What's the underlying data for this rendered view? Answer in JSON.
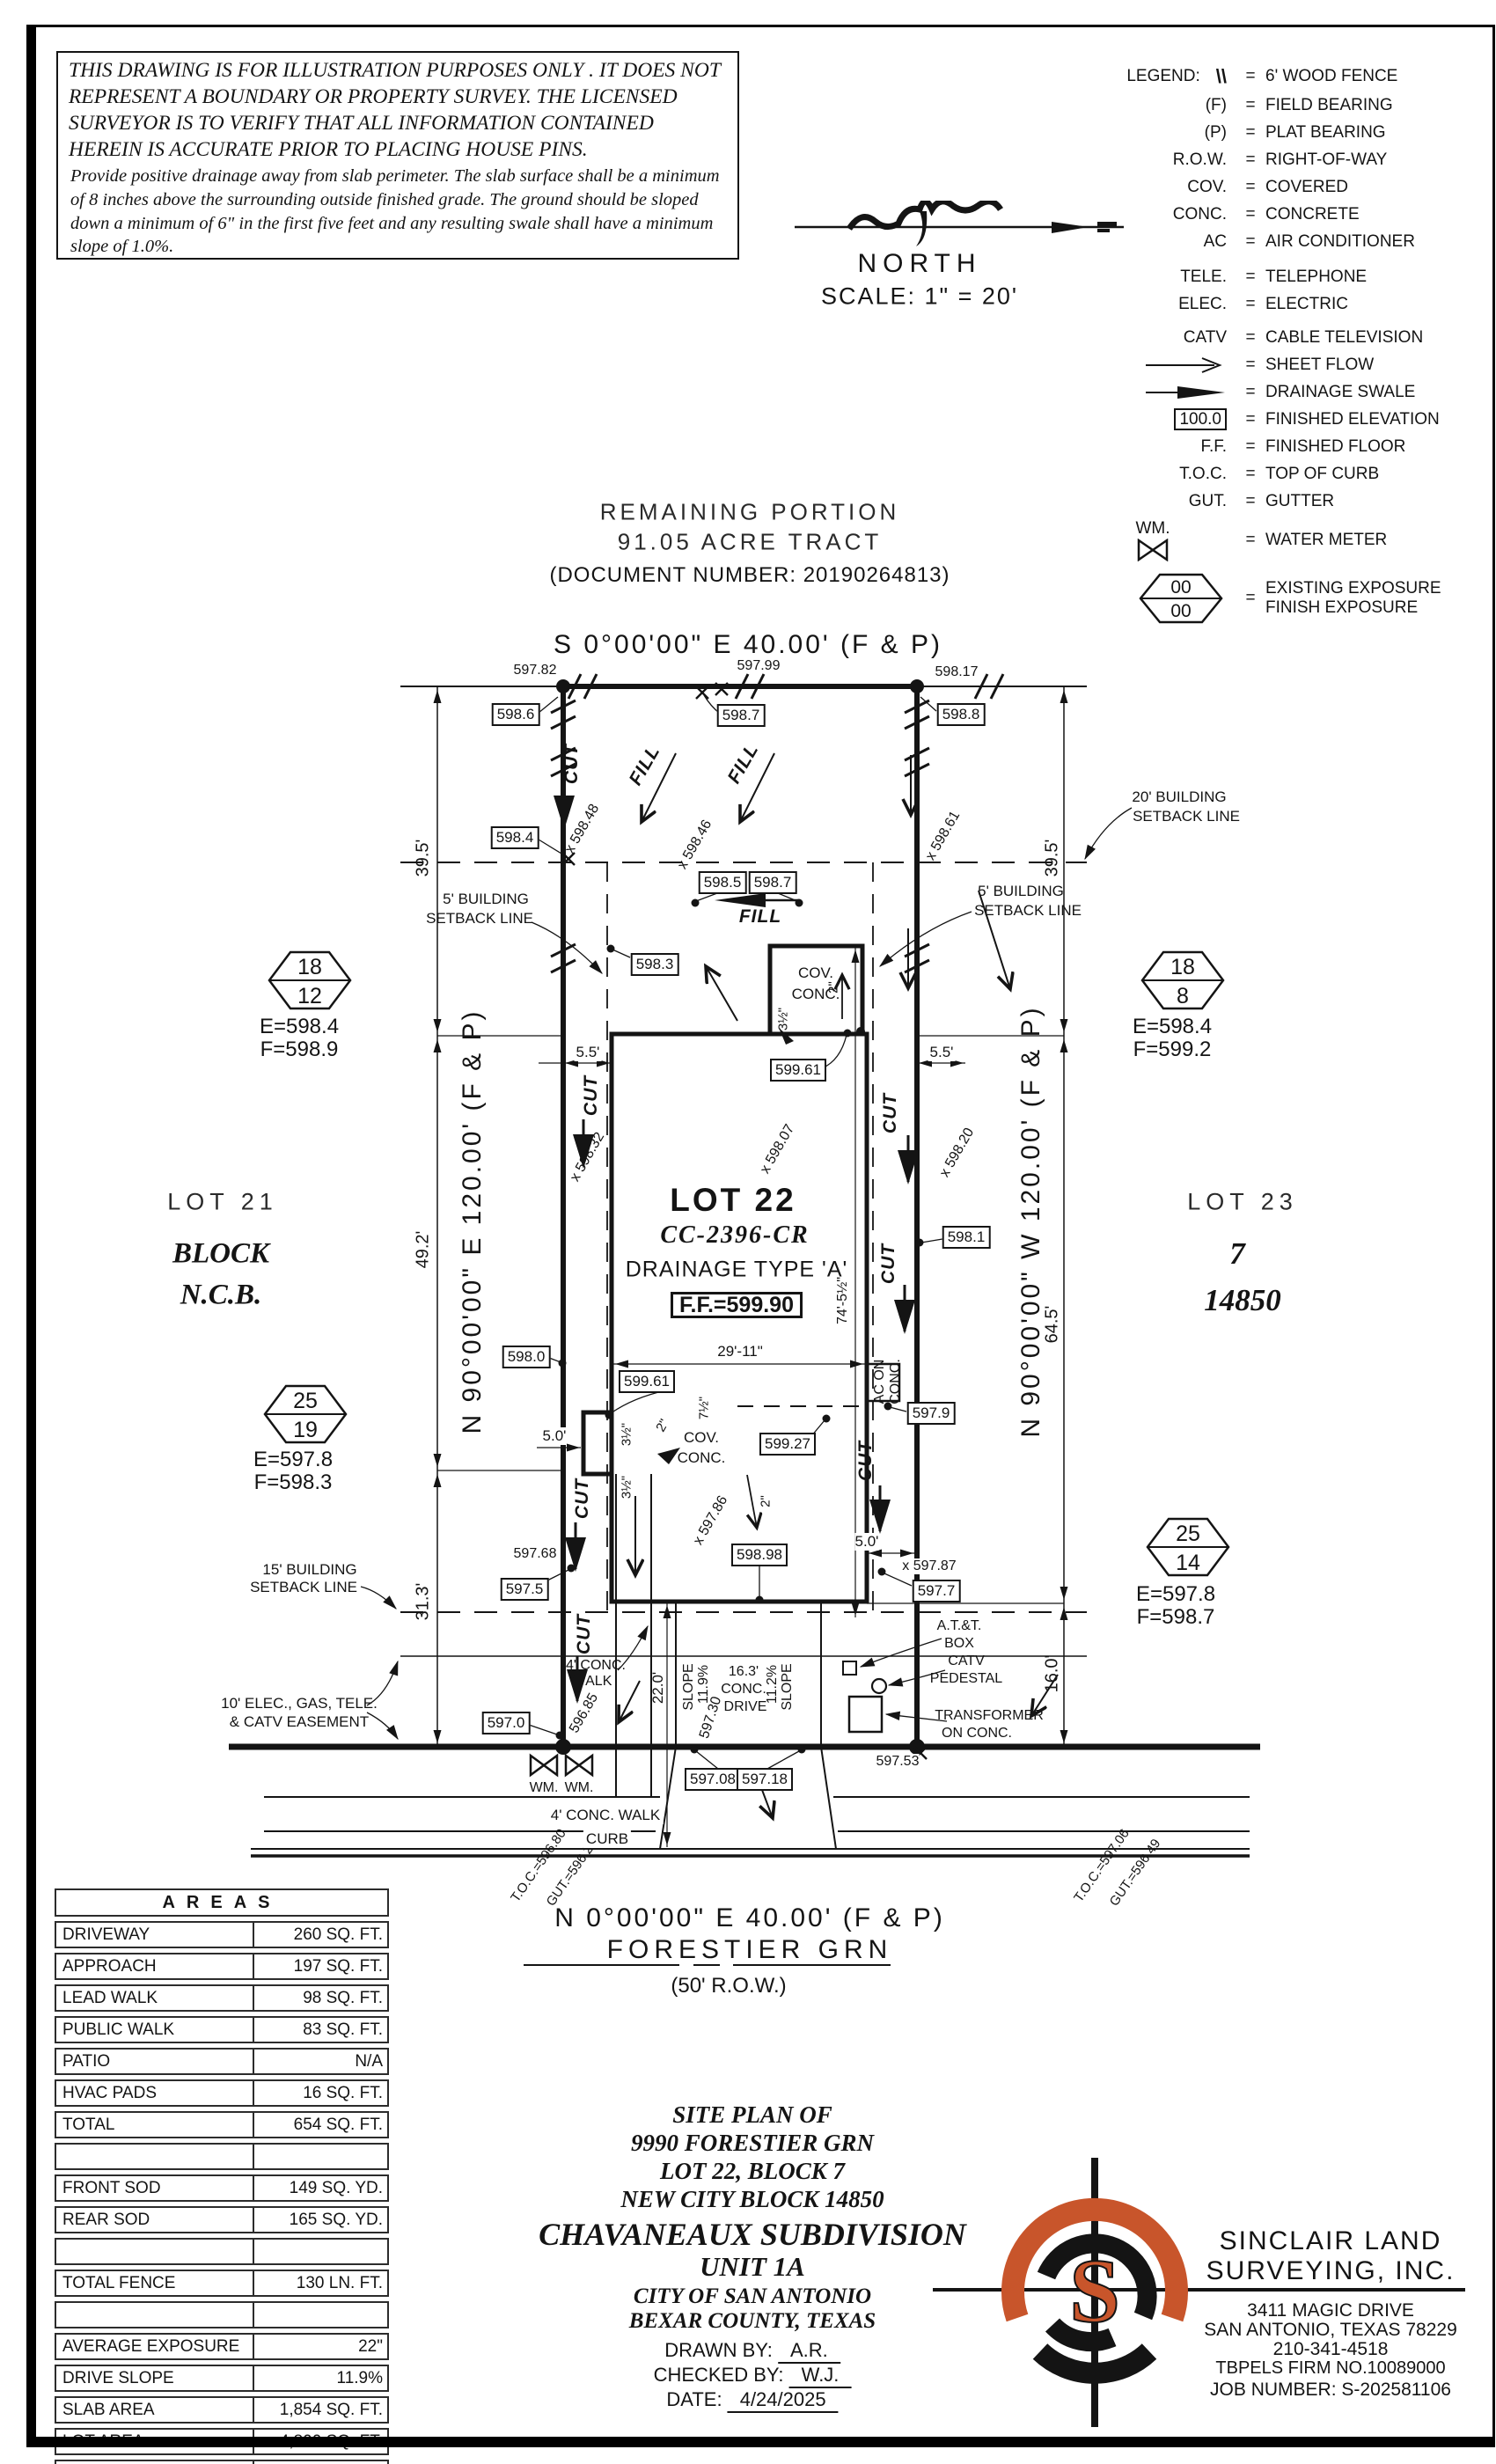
{
  "page": {
    "ink": "#141414",
    "accent_orange": "#C8552B"
  },
  "disclaimer": {
    "p1": "THIS DRAWING IS FOR ILLUSTRATION PURPOSES ONLY . IT DOES NOT REPRESENT A BOUNDARY OR PROPERTY SURVEY. THE LICENSED SURVEYOR IS TO VERIFY THAT ALL INFORMATION CONTAINED HEREIN IS ACCURATE PRIOR TO PLACING HOUSE PINS.",
    "p2": "Provide positive drainage away from slab perimeter. The slab surface shall be a minimum of 8 inches above the surrounding outside finished grade. The ground should be sloped down a minimum of 6\" in the first five feet and any resulting swale shall have a minimum slope of 1.0%."
  },
  "compass": {
    "north": "NORTH",
    "scale": "SCALE:  1\" = 20'"
  },
  "tract": {
    "l1": "REMAINING PORTION",
    "l2": "91.05 ACRE TRACT",
    "l3": "(DOCUMENT NUMBER:  20190264813)"
  },
  "legend": {
    "title": "LEGEND:",
    "eq": "=",
    "items": [
      {
        "sym": "\\\\",
        "label": "6' WOOD FENCE"
      },
      {
        "sym": "(F)",
        "label": "FIELD BEARING"
      },
      {
        "sym": "(P)",
        "label": "PLAT BEARING"
      },
      {
        "sym": "R.O.W.",
        "label": "RIGHT-OF-WAY"
      },
      {
        "sym": "COV.",
        "label": "COVERED"
      },
      {
        "sym": "CONC.",
        "label": "CONCRETE"
      },
      {
        "sym": "AC",
        "label": "AIR CONDITIONER"
      },
      {
        "sym": "TELE.",
        "label": "TELEPHONE"
      },
      {
        "sym": "ELEC.",
        "label": "ELECTRIC"
      },
      {
        "sym": "CATV",
        "label": "CABLE TELEVISION"
      },
      {
        "label": "SHEET FLOW"
      },
      {
        "label": "DRAINAGE SWALE"
      },
      {
        "sym": "100.0",
        "label": "FINISHED ELEVATION"
      },
      {
        "sym": "F.F.",
        "label": "FINISHED FLOOR"
      },
      {
        "sym": "T.O.C.",
        "label": "TOP OF CURB"
      },
      {
        "sym": "GUT.",
        "label": "GUTTER"
      },
      {
        "sym": "WM.",
        "label": "WATER METER"
      },
      {
        "sym": "00",
        "sym2": "00",
        "label": "EXISTING EXPOSURE",
        "label2": "FINISH EXPOSURE"
      }
    ]
  },
  "plot": {
    "bearing_top": "S 0°00'00\" E 40.00' (F & P)",
    "bearing_bottom": "N 0°00'00\" E 40.00' (F & P)",
    "bearing_left": "N 90°00'00\" E 120.00' (F & P)",
    "bearing_right": "N 90°00'00\" W 120.00' (F & P)",
    "street_name": "FORESTIER GRN",
    "street_row": "(50' R.O.W.)",
    "cut": "CUT",
    "fill": "FILL",
    "wm": "WM.",
    "curb": "CURB",
    "cov": "COV.",
    "conc": "CONC.",
    "ac1": "AC ON",
    "ac2": "CONC.",
    "lot21": {
      "name": "LOT 21",
      "l2": "BLOCK",
      "l3": "N.C.B."
    },
    "lot22": {
      "name": "LOT 22",
      "plan": "CC-2396-CR",
      "drainage": "DRAINAGE TYPE 'A'",
      "ff": "F.F.=599.90"
    },
    "lot23": {
      "name": "LOT 23",
      "block": "7",
      "ncb": "14850"
    },
    "setbacks": {
      "s20a": "20' BUILDING",
      "s20b": "SETBACK LINE",
      "s5a": "5' BUILDING",
      "s5b": "SETBACK LINE",
      "s15a": "15' BUILDING",
      "s15b": "SETBACK LINE",
      "easea": "10' ELEC., GAS, TELE.",
      "easeb": "& CATV EASEMENT"
    },
    "dims": {
      "d395": "39.5'",
      "d492": "49.2'",
      "d313": "31.3'",
      "d645": "64.5'",
      "d160": "16.0'",
      "d55": "5.5'",
      "d50": "5.0'",
      "d2911": "29'-11\"",
      "d745": "74'-5½\"",
      "d35": "3½\"",
      "d2": "2\"",
      "d75": "7½\"",
      "d220": "22.0'",
      "d163a": "16.3'",
      "d163b": "CONC.",
      "d163c": "DRIVE",
      "slope": "SLOPE",
      "s119": "11.9%",
      "s112": "11.2%",
      "walk4a": "4' CONC.",
      "walk4b": "WALK",
      "walk4": "4' CONC. WALK"
    },
    "sp": {
      "t82": "597.82",
      "t99": "597.99",
      "t17": "598.17",
      "x48": "x 598.48",
      "x46": "x 598.46",
      "x61": "x 598.61",
      "x32": "x 598.32",
      "x07": "x 598.07",
      "x20": "x 598.20",
      "x86": "x 597.86",
      "x87": "x 597.87",
      "s68": "597.68",
      "s85": "596.85",
      "s30": "597.30",
      "s53": "597.53"
    },
    "box": {
      "b5986": "598.6",
      "b5987": "598.7",
      "b5988": "598.8",
      "b5984": "598.4",
      "b5985": "598.5",
      "b5987b": "598.7",
      "b5983": "598.3",
      "b5980": "598.0",
      "b5981": "598.1",
      "b59961": "599.61",
      "b59961b": "599.61",
      "b59927": "599.27",
      "b5979": "597.9",
      "b59898": "598.98",
      "b5975": "597.5",
      "b5977": "597.7",
      "b5970": "597.0",
      "b59708": "597.08",
      "b59718": "597.18"
    },
    "toc": {
      "l1": "T.O.C.=596.80",
      "l2": "GUT.=596.23",
      "r1": "T.O.C.=597.06",
      "r2": "GUT.=596.49"
    },
    "misc": {
      "att1": "A.T.&T.",
      "att2": "BOX",
      "catv1": "CATV",
      "catv2": "PEDESTAL",
      "tx1": "TRANSFORMER",
      "tx2": "ON CONC."
    },
    "exposure": [
      {
        "top": "18",
        "bot": "12",
        "e": "E=598.4",
        "f": "F=598.9"
      },
      {
        "top": "18",
        "bot": "8",
        "e": "E=598.4",
        "f": "F=599.2"
      },
      {
        "top": "25",
        "bot": "19",
        "e": "E=597.8",
        "f": "F=598.3"
      },
      {
        "top": "25",
        "bot": "14",
        "e": "E=597.8",
        "f": "F=598.7"
      }
    ]
  },
  "areas": {
    "title": "AREAS",
    "rows": [
      {
        "label": "DRIVEWAY",
        "value": "260 SQ. FT."
      },
      {
        "label": "APPROACH",
        "value": "197 SQ. FT."
      },
      {
        "label": "LEAD WALK",
        "value": "98 SQ. FT."
      },
      {
        "label": "PUBLIC WALK",
        "value": "83 SQ. FT."
      },
      {
        "label": "PATIO",
        "value": "N/A"
      },
      {
        "label": "HVAC PADS",
        "value": "16 SQ. FT."
      },
      {
        "label": "TOTAL",
        "value": "654 SQ. FT."
      },
      {
        "label": "",
        "value": ""
      },
      {
        "label": "FRONT SOD",
        "value": "149 SQ. YD."
      },
      {
        "label": "REAR SOD",
        "value": "165 SQ. YD."
      },
      {
        "label": "",
        "value": ""
      },
      {
        "label": "TOTAL FENCE",
        "value": "130 LN. FT."
      },
      {
        "label": "",
        "value": ""
      },
      {
        "label": "AVERAGE EXPOSURE",
        "value": "22\""
      },
      {
        "label": "DRIVE SLOPE",
        "value": "11.9%"
      },
      {
        "label": "SLAB AREA",
        "value": "1,854 SQ. FT."
      },
      {
        "label": "LOT AREA",
        "value": "4,800 SQ. FT."
      },
      {
        "label": "",
        "value": ""
      }
    ]
  },
  "titleblock": {
    "l1": "SITE PLAN OF",
    "l2": "9990 FORESTIER GRN",
    "l3": "LOT 22, BLOCK 7",
    "l4": "NEW CITY BLOCK 14850",
    "l5": "CHAVANEAUX SUBDIVISION",
    "l6": "UNIT 1A",
    "l7": "CITY OF SAN ANTONIO",
    "l8": "BEXAR COUNTY, TEXAS",
    "drawn_label": "DRAWN BY:",
    "drawn": "A.R.",
    "checked_label": "CHECKED BY:",
    "checked": "W.J.",
    "date_label": "DATE:",
    "date": "4/24/2025"
  },
  "company": {
    "logo_s": "S",
    "name1": "SINCLAIR LAND",
    "name2": "SURVEYING, INC.",
    "addr1": "3411 MAGIC DRIVE",
    "addr2": "SAN ANTONIO, TEXAS 78229",
    "phone": "210-341-4518",
    "firm": "TBPELS FIRM NO.10089000",
    "job": "JOB NUMBER: S-202581106"
  }
}
